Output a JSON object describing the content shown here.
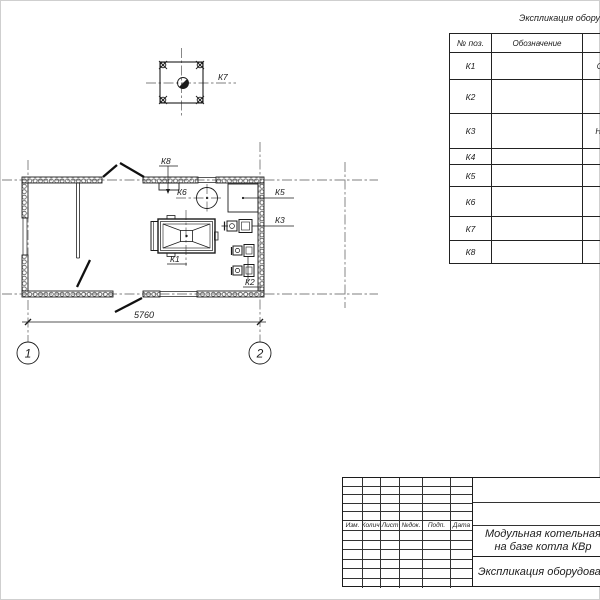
{
  "legend": {
    "title": "Экспликация обору",
    "col_pos": "№ поз.",
    "col_designation": "Обозначение",
    "rows": [
      {
        "pos": "К1",
        "designation": "",
        "name_fragment": "Стал"
      },
      {
        "pos": "К2",
        "designation": "",
        "name_fragment": "На"
      },
      {
        "pos": "К3",
        "designation": "",
        "name_fragment": "Насос"
      },
      {
        "pos": "К4",
        "designation": "",
        "name_fragment": "Гр"
      },
      {
        "pos": "К5",
        "designation": "",
        "name_fragment": ""
      },
      {
        "pos": "К6",
        "designation": "",
        "name_fragment": "Б"
      },
      {
        "pos": "К7",
        "designation": "",
        "name_fragment": ""
      },
      {
        "pos": "К8",
        "designation": "",
        "name_fragment": ""
      }
    ]
  },
  "plan": {
    "equipment_labels": {
      "k1": "К1",
      "k2": "К2",
      "k3": "К3",
      "k5": "К5",
      "k6": "К6",
      "k7": "К7",
      "k8": "К8"
    },
    "dimension_width": "5760",
    "axis_left": "1",
    "axis_right": "2"
  },
  "title_block": {
    "cols": [
      "Изм.",
      "Колич.",
      "Лист",
      "№док.",
      "Подп.",
      "Дата"
    ],
    "doc_title_line1": "Модульная котельная",
    "doc_title_line2": "на базе котла КВр",
    "sheet_name": "Экспликация оборудовани"
  },
  "colors": {
    "line": "#1c1c1c",
    "background": "#ffffff"
  }
}
